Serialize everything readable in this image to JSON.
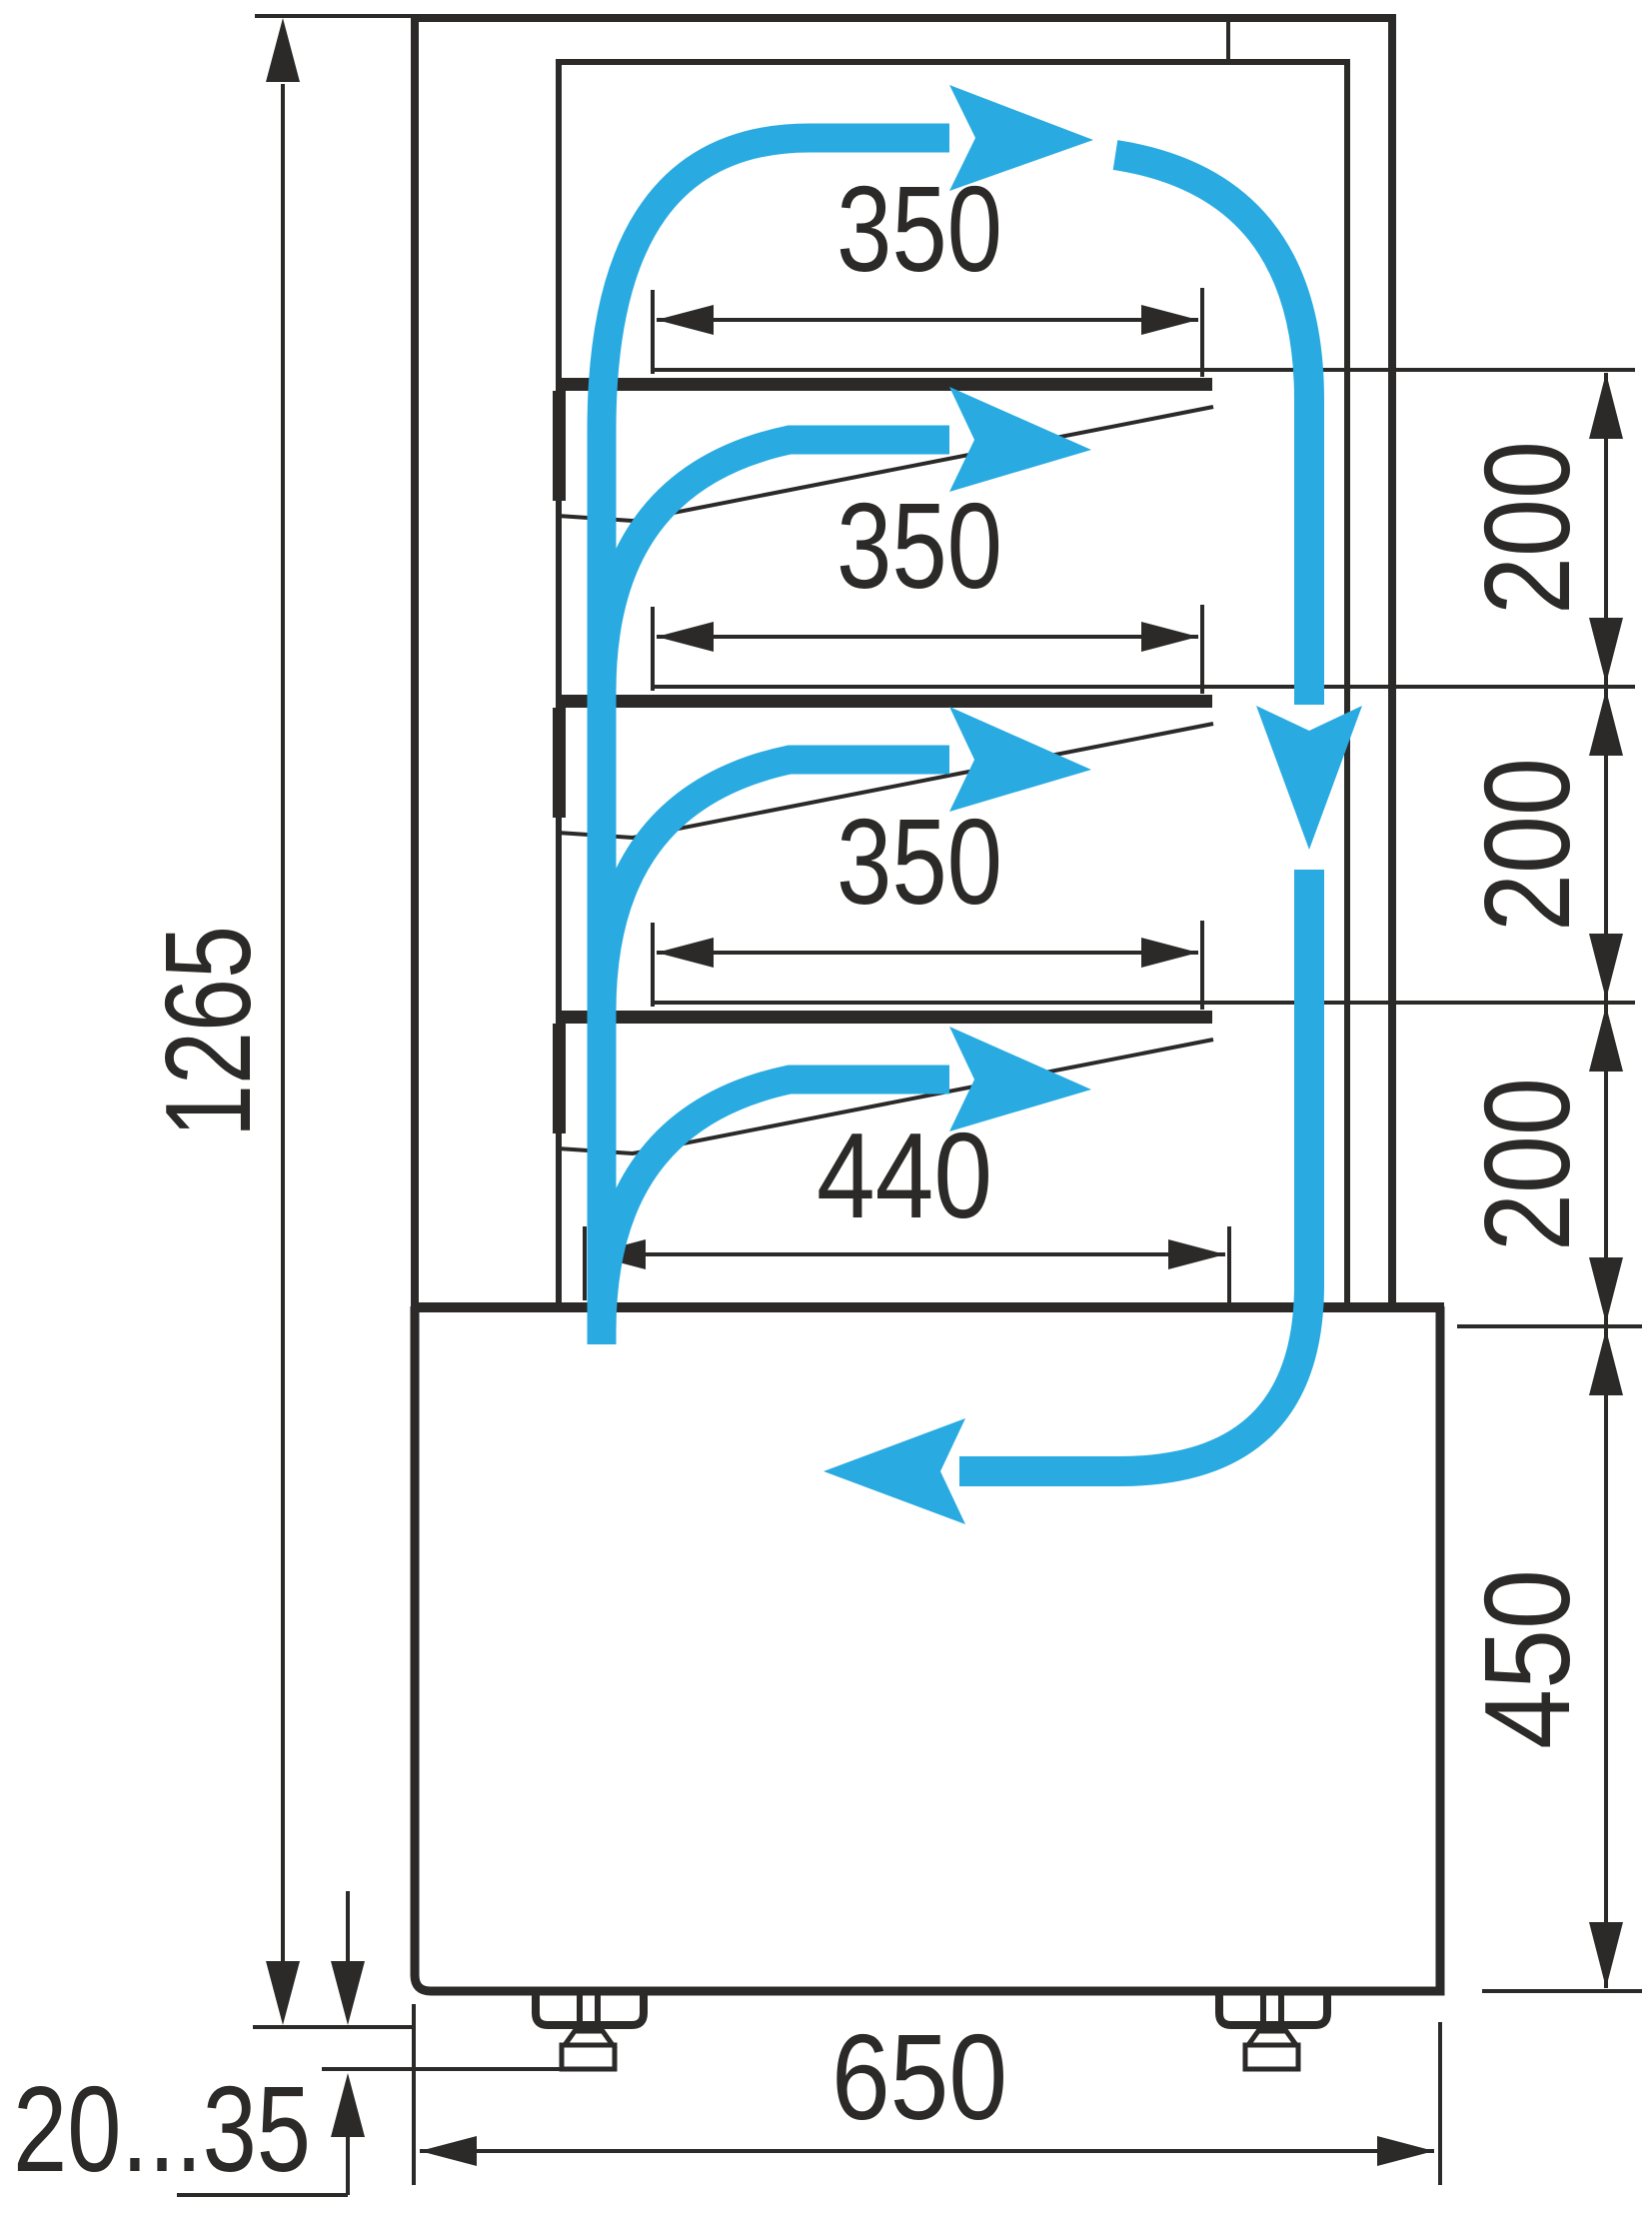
{
  "diagram": {
    "kind": "technical-drawing",
    "subject": "refrigerated-display-case-side-section-with-airflow",
    "colors": {
      "line": "#2b2a29",
      "flow": "#29abe2",
      "background": "#ffffff"
    },
    "dimensions": {
      "total_height": "1265",
      "shelf_widths": [
        "350",
        "350",
        "350"
      ],
      "base_shelf_width": "440",
      "shelf_gaps": [
        "200",
        "200",
        "200"
      ],
      "base_height": "450",
      "depth": "650",
      "foot_adjustment": "20...35"
    },
    "airflow": {
      "color": "#29abe2",
      "arrows": [
        "airflow-top-right-arrow",
        "airflow-down-right-arrow",
        "airflow-bottom-left-arrow",
        "airflow-shelf-1-arrow",
        "airflow-shelf-2-arrow",
        "airflow-shelf-3-arrow"
      ]
    }
  }
}
